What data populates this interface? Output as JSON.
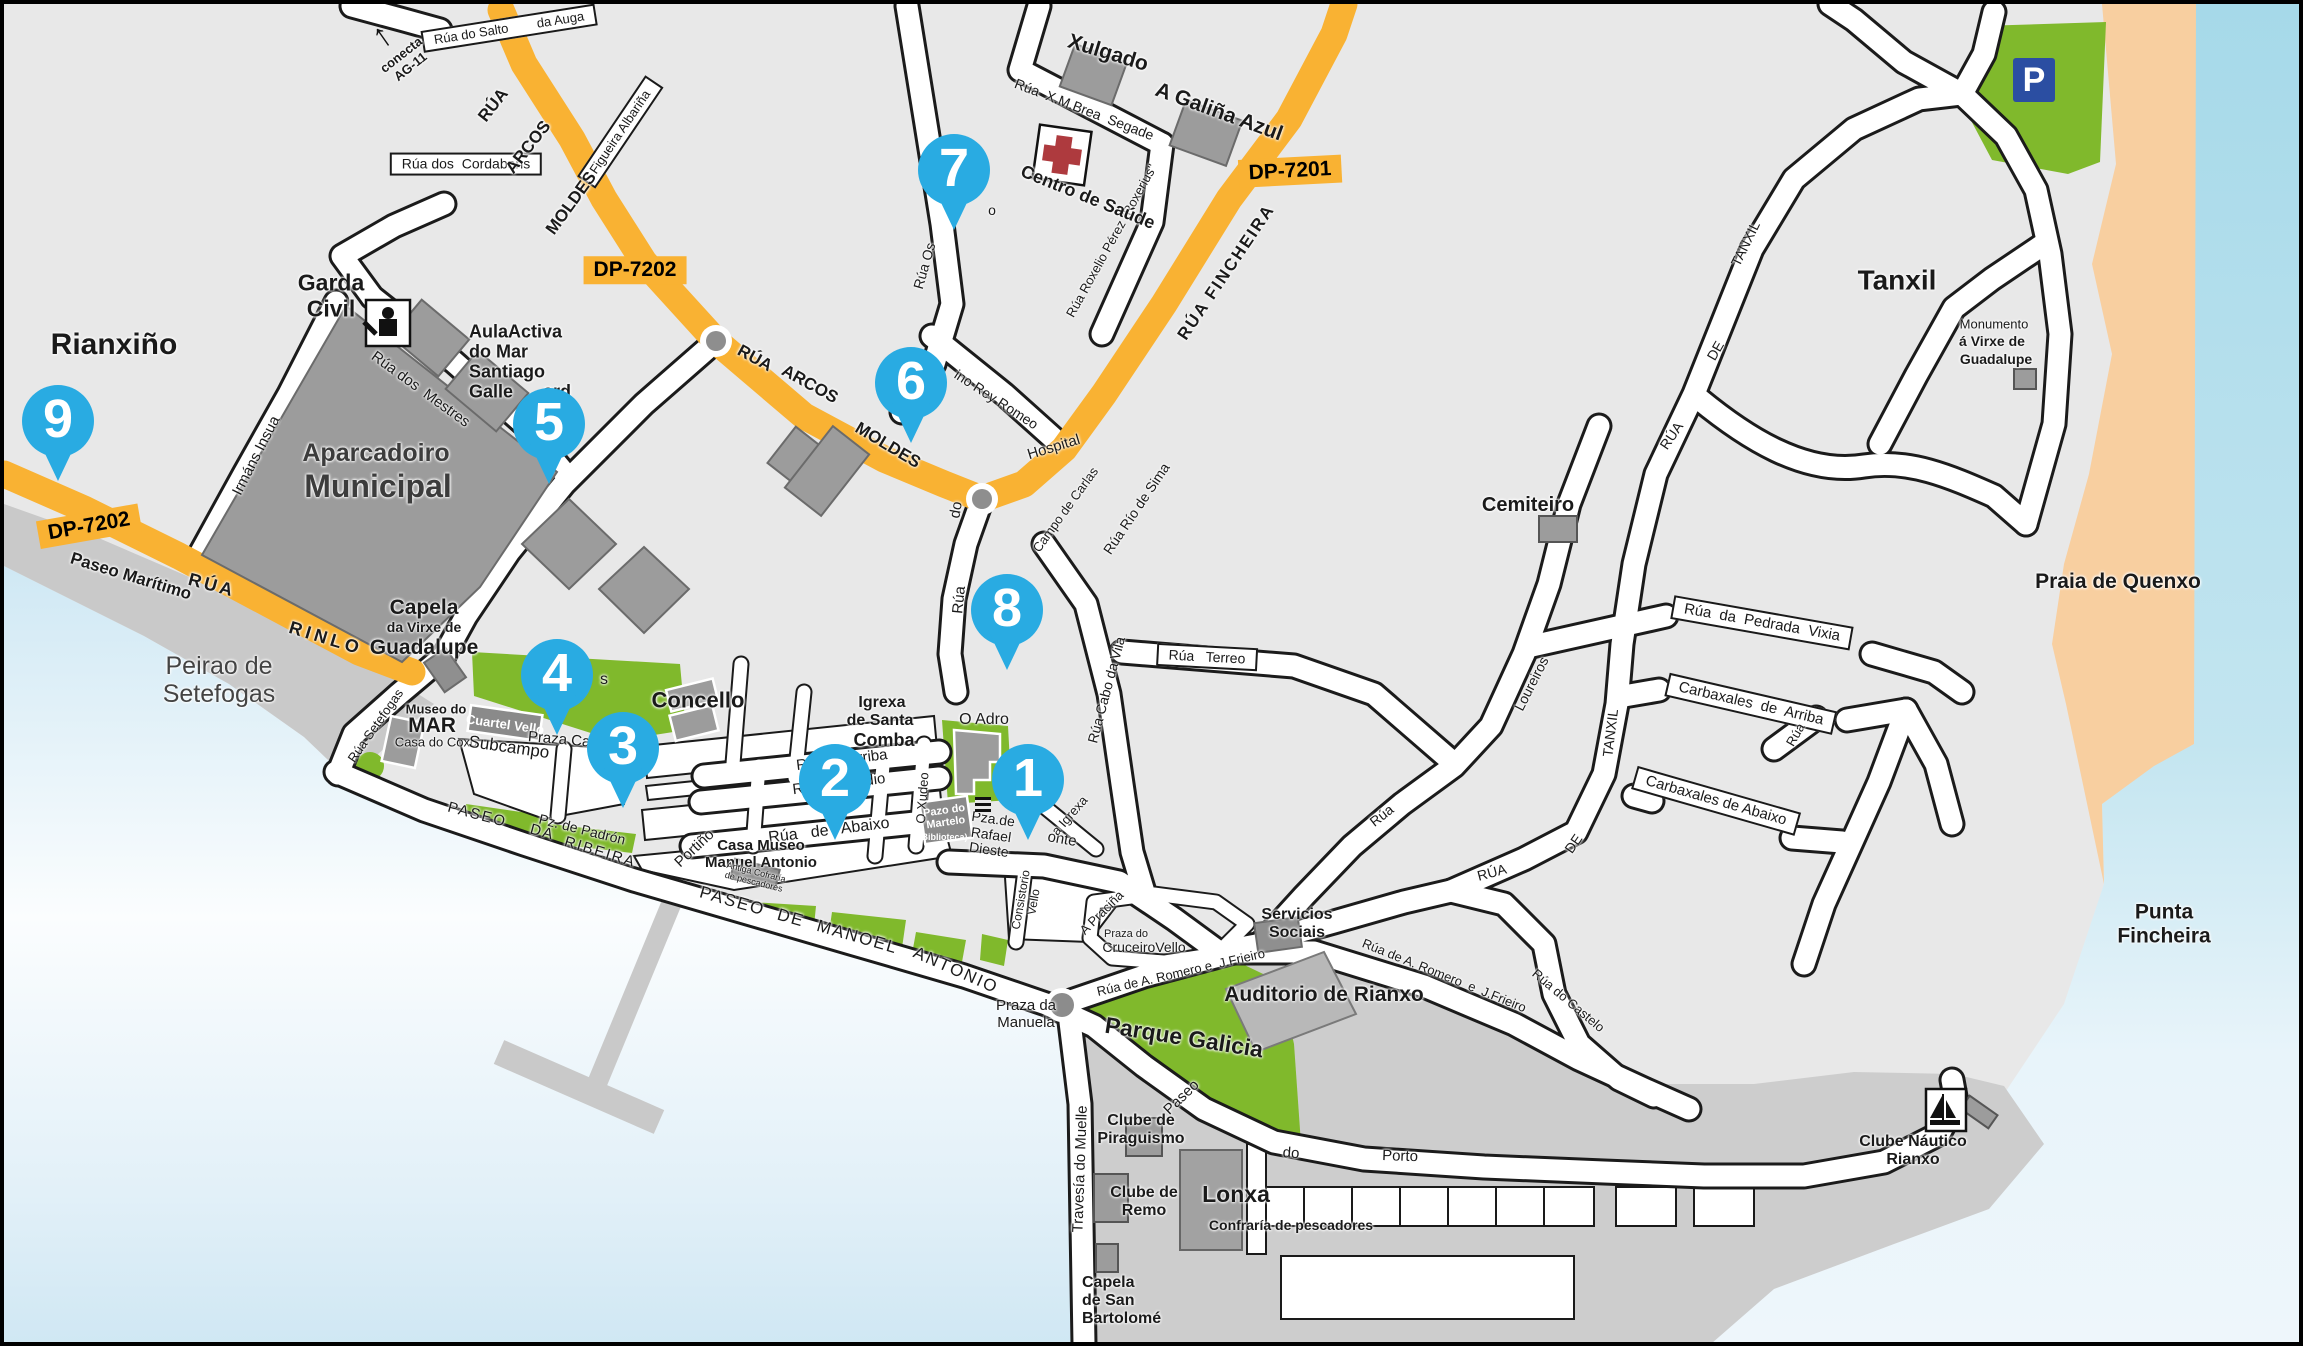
{
  "map_title": "Rianxo town street map",
  "colors": {
    "land": "#e8e8e8",
    "sea_deep": "#a6d9e9",
    "sea_pale": "#eef6fb",
    "sand": "#f8cfa0",
    "park_green": "#80b92c",
    "building_gray": "#9c9c9c",
    "quay_gray": "#c9c9c9",
    "port_gray": "#cdcdcd",
    "road_orange": "#F9B233",
    "marker_blue": "#29ABE2",
    "parking_blue": "#2B4EA2",
    "cross_red": "#AE3A3E"
  },
  "markers": [
    {
      "n": "1",
      "x": 1024,
      "y": 776
    },
    {
      "n": "2",
      "x": 831,
      "y": 776
    },
    {
      "n": "3",
      "x": 619,
      "y": 744
    },
    {
      "n": "4",
      "x": 553,
      "y": 671
    },
    {
      "n": "5",
      "x": 545,
      "y": 420
    },
    {
      "n": "6",
      "x": 907,
      "y": 379
    },
    {
      "n": "7",
      "x": 950,
      "y": 166
    },
    {
      "n": "8",
      "x": 1003,
      "y": 606
    },
    {
      "n": "9",
      "x": 54,
      "y": 417
    }
  ],
  "icons": [
    {
      "type": "parking",
      "glyph": "P",
      "x": 2030,
      "y": 76
    },
    {
      "type": "arrow-up",
      "glyph": "↑",
      "x": 378,
      "y": 32,
      "r": -35
    },
    {
      "type": "stairs",
      "glyph": "",
      "x": 979,
      "y": 801
    }
  ],
  "labels": [
    {
      "n": "rianxino",
      "t": "Rianxiño",
      "x": 110,
      "y": 341,
      "s": 30,
      "w": 700
    },
    {
      "n": "badge-dp7202-west",
      "t": "DP-7202",
      "x": 85,
      "y": 522,
      "s": 21,
      "w": 700,
      "bg": "orange",
      "r": -10
    },
    {
      "n": "paseo-maritimo",
      "t": "Paseo Marítimo",
      "x": 127,
      "y": 572,
      "s": 17,
      "w": 700,
      "r": 17
    },
    {
      "n": "rua-rinlo-1",
      "t": "RÚA",
      "x": 208,
      "y": 581,
      "s": 18,
      "w": 700,
      "r": 15,
      "ls": 3
    },
    {
      "n": "rua-rinlo-2",
      "t": "RINLO",
      "x": 322,
      "y": 634,
      "s": 18,
      "w": 700,
      "r": 17,
      "ls": 4
    },
    {
      "n": "peirao-setefogas",
      "t": "Peirao de\nSetefogas",
      "x": 215,
      "y": 676,
      "s": 25,
      "c": "#444"
    },
    {
      "n": "garda-civil",
      "t": "Garda\nCivil",
      "x": 327,
      "y": 292,
      "s": 23,
      "w": 700
    },
    {
      "n": "irmans-insua",
      "t": "Irmáns Insua",
      "x": 253,
      "y": 452,
      "s": 15,
      "r": -63
    },
    {
      "n": "rua-dos-mestres",
      "t": "Rúa dos  Mestres",
      "x": 416,
      "y": 386,
      "s": 15,
      "r": 36
    },
    {
      "n": "aparcadoiro",
      "t": "Aparcadoiro",
      "x": 372,
      "y": 449,
      "s": 25,
      "w": 700,
      "c": "#3c3c3c"
    },
    {
      "n": "municipal",
      "t": "Municipal",
      "x": 374,
      "y": 483,
      "s": 32,
      "w": 700,
      "c": "#3c3c3c"
    },
    {
      "n": "capela-guadalupe-1",
      "t": "Capela",
      "x": 420,
      "y": 604,
      "s": 21,
      "w": 700
    },
    {
      "n": "capela-guadalupe-2",
      "t": "da Virxe de",
      "x": 420,
      "y": 624,
      "s": 14,
      "w": 700
    },
    {
      "n": "capela-guadalupe-3",
      "t": "Guadalupe",
      "x": 420,
      "y": 644,
      "s": 21,
      "w": 700
    },
    {
      "n": "museo-do-mar-1",
      "t": "Museo do",
      "x": 432,
      "y": 706,
      "s": 13,
      "w": 700
    },
    {
      "n": "museo-do-mar-2",
      "t": "MAR",
      "x": 428,
      "y": 722,
      "s": 21,
      "w": 700
    },
    {
      "n": "casa-do-coxo",
      "t": "Casa do Coxo",
      "x": 432,
      "y": 739,
      "s": 13
    },
    {
      "n": "cuartel-vello",
      "t": "Cuartel Vello",
      "x": 501,
      "y": 721,
      "s": 13,
      "w": 700,
      "c": "#fff",
      "r": 8,
      "hl": 1
    },
    {
      "n": "subcampo",
      "t": "Subcampo",
      "x": 505,
      "y": 743,
      "s": 17,
      "r": 8
    },
    {
      "n": "praza-castelao",
      "t": "Praza Castelao",
      "x": 575,
      "y": 738,
      "s": 15,
      "r": 5
    },
    {
      "n": "green-fragment",
      "t": "s",
      "x": 600,
      "y": 676,
      "s": 16
    },
    {
      "n": "concello",
      "t": "Concello",
      "x": 694,
      "y": 697,
      "s": 22,
      "w": 700
    },
    {
      "n": "rua-setefogas",
      "t": "Rúa Setefogas",
      "x": 372,
      "y": 722,
      "s": 13,
      "r": -55
    },
    {
      "n": "aulaactiva",
      "t": "AulaActiva\ndo Mar\nSantiago\nGalle      ard",
      "x": 465,
      "y": 358,
      "s": 18,
      "w": 700,
      "al": "l"
    },
    {
      "n": "conecta-ag11",
      "t": "conecta\nAG-11",
      "x": 402,
      "y": 57,
      "s": 13,
      "w": 700,
      "r": -38
    },
    {
      "n": "rua-salto-auga",
      "t": "Rúa do Salto        da Auga",
      "x": 505,
      "y": 24,
      "s": 13,
      "bg": "box",
      "r": -9
    },
    {
      "n": "rua-cordabans",
      "t": "Rúa dos  Cordabans",
      "x": 462,
      "y": 160,
      "s": 14,
      "bg": "box"
    },
    {
      "n": "figueira-albarina",
      "t": "Figueira Albariña",
      "x": 616,
      "y": 128,
      "s": 13,
      "bg": "box",
      "r": -56
    },
    {
      "n": "badge-dp7202-top",
      "t": "DP-7202",
      "x": 631,
      "y": 266,
      "s": 21,
      "w": 700,
      "bg": "orange"
    },
    {
      "n": "badge-dp7201",
      "t": "DP-7201",
      "x": 1286,
      "y": 167,
      "s": 21,
      "w": 700,
      "bg": "orange",
      "r": -3
    },
    {
      "n": "arcos-moldes-nw1",
      "t": "RÚA",
      "x": 489,
      "y": 101,
      "s": 17,
      "w": 700,
      "r": -52
    },
    {
      "n": "arcos-moldes-nw2",
      "t": "ARCOS",
      "x": 524,
      "y": 143,
      "s": 17,
      "w": 700,
      "r": -52
    },
    {
      "n": "arcos-moldes-nw3",
      "t": "MOLDES",
      "x": 567,
      "y": 199,
      "s": 17,
      "w": 700,
      "r": -54
    },
    {
      "n": "arcos-moldes-mid1",
      "t": "RÚA",
      "x": 751,
      "y": 354,
      "s": 17,
      "w": 700,
      "r": 29
    },
    {
      "n": "arcos-moldes-mid2",
      "t": "ARCOS",
      "x": 806,
      "y": 380,
      "s": 17,
      "w": 700,
      "r": 29
    },
    {
      "n": "arcos-moldes-mid3",
      "t": "MOLDES",
      "x": 884,
      "y": 441,
      "s": 17,
      "w": 700,
      "r": 31
    },
    {
      "n": "rua-fincheira",
      "t": "RÚA FINCHEIRA",
      "x": 1222,
      "y": 268,
      "s": 17,
      "w": 700,
      "r": -56,
      "ls": 2
    },
    {
      "n": "xulgado",
      "t": "Xulgado",
      "x": 1104,
      "y": 49,
      "s": 21,
      "w": 700,
      "r": 17
    },
    {
      "n": "galina-azul",
      "t": "A Galiña Azul",
      "x": 1215,
      "y": 108,
      "s": 21,
      "w": 700,
      "r": 20
    },
    {
      "n": "rua-brea-segade",
      "t": "Rúa  X.M.Brea  Segade",
      "x": 1080,
      "y": 106,
      "s": 14,
      "r": 21
    },
    {
      "n": "rua-roxelio",
      "t": "Rúa Roxelio Pérez \"Roxerius\"",
      "x": 1108,
      "y": 237,
      "s": 13,
      "r": -61
    },
    {
      "n": "centro-de-saude",
      "t": "Centro de Saúde",
      "x": 1084,
      "y": 193,
      "s": 18,
      "w": 700,
      "r": 22
    },
    {
      "n": "o-fragment",
      "t": "o",
      "x": 988,
      "y": 207,
      "s": 14
    },
    {
      "n": "rua-os",
      "t": "Rúa Os",
      "x": 921,
      "y": 262,
      "s": 14,
      "r": -74
    },
    {
      "n": "rey-romeo",
      "t": "ino Rey Romeo",
      "x": 992,
      "y": 396,
      "s": 14,
      "r": 33
    },
    {
      "n": "hospital",
      "t": "Hospital",
      "x": 1050,
      "y": 444,
      "s": 15,
      "r": -17
    },
    {
      "n": "hospital-do",
      "t": "do",
      "x": 953,
      "y": 506,
      "s": 15,
      "r": -80
    },
    {
      "n": "hospital-rua",
      "t": "Rúa",
      "x": 956,
      "y": 596,
      "s": 15,
      "r": -84
    },
    {
      "n": "campo-de-carlas",
      "t": "Campo de Carlas",
      "x": 1062,
      "y": 506,
      "s": 13,
      "r": -54
    },
    {
      "n": "rua-rio-de-sima",
      "t": "Rúa Río de Sima",
      "x": 1133,
      "y": 505,
      "s": 14,
      "r": -56
    },
    {
      "n": "rua-terreo",
      "t": "Rúa   Terreo",
      "x": 1203,
      "y": 653,
      "s": 14,
      "bg": "box",
      "r": 3
    },
    {
      "n": "rua-cabo-da-vila",
      "t": "Rúa Cabo da Vila",
      "x": 1103,
      "y": 686,
      "s": 14,
      "r": -75
    },
    {
      "n": "igrexa-1",
      "t": "Igrexa",
      "x": 878,
      "y": 699,
      "s": 16,
      "w": 700
    },
    {
      "n": "igrexa-2",
      "t": "de Santa",
      "x": 876,
      "y": 717,
      "s": 16,
      "w": 700
    },
    {
      "n": "igrexa-3",
      "t": "Comba",
      "x": 880,
      "y": 736,
      "s": 18,
      "w": 700
    },
    {
      "n": "o-adro",
      "t": "O Adro",
      "x": 980,
      "y": 716,
      "s": 16
    },
    {
      "n": "onte-fragment",
      "t": "onte",
      "x": 1058,
      "y": 836,
      "s": 15,
      "r": 10
    },
    {
      "n": "a-igrexa",
      "t": "a Igrexa",
      "x": 1066,
      "y": 812,
      "s": 13,
      "r": -49
    },
    {
      "n": "rua-de-arriba",
      "t": "Rúa de Arriba",
      "x": 838,
      "y": 757,
      "s": 15,
      "r": -7
    },
    {
      "n": "rua-do-medio",
      "t": "Rúa do Medio",
      "x": 835,
      "y": 781,
      "s": 15,
      "r": -7
    },
    {
      "n": "rua-de-abaixo",
      "t": "Rúa   de   Abaixo",
      "x": 825,
      "y": 827,
      "s": 16,
      "r": -7
    },
    {
      "n": "o-xudeo",
      "t": "O Xudeo",
      "x": 919,
      "y": 794,
      "s": 13,
      "r": -86
    },
    {
      "n": "pazo-do-martelo",
      "t": "Pazo do\nMartelo",
      "x": 941,
      "y": 813,
      "s": 11,
      "w": 700,
      "c": "#fff",
      "r": -8,
      "hl": 1
    },
    {
      "n": "biblioteca",
      "t": "(Biblioteca)",
      "x": 939,
      "y": 833,
      "s": 9,
      "w": 700,
      "c": "#fff",
      "hl": 1
    },
    {
      "n": "pza-rafael-dieste",
      "t": "Pza.de\nRafael\nDieste",
      "x": 987,
      "y": 831,
      "s": 14,
      "r": 8
    },
    {
      "n": "casa-museo",
      "t": "Casa Museo\nManuel Antonio",
      "x": 757,
      "y": 851,
      "s": 15,
      "w": 700
    },
    {
      "n": "antiga-cofraria",
      "t": "Antiga Cofraría\nde pescadores",
      "x": 751,
      "y": 873,
      "s": 9,
      "r": 14
    },
    {
      "n": "portino",
      "t": "Portiño",
      "x": 691,
      "y": 845,
      "s": 15,
      "r": -43
    },
    {
      "n": "pz-de-padron",
      "t": "Pz. de Padrón",
      "x": 578,
      "y": 826,
      "s": 14,
      "r": 14
    },
    {
      "n": "paseo-da",
      "t": "PASEO    DA",
      "x": 497,
      "y": 818,
      "s": 15,
      "r": 15,
      "ls": 2
    },
    {
      "n": "ribeira",
      "t": "RIBEIRA",
      "x": 596,
      "y": 849,
      "s": 15,
      "r": 17,
      "ls": 2
    },
    {
      "n": "paseo-manoel-1",
      "t": "PASEO  DE  MANOEL",
      "x": 795,
      "y": 916,
      "s": 17,
      "r": 16,
      "ls": 2
    },
    {
      "n": "paseo-manoel-2",
      "t": "ANTONIO",
      "x": 952,
      "y": 966,
      "s": 17,
      "r": 24,
      "ls": 2
    },
    {
      "n": "praza-da-manuela",
      "t": "Praza da\nManuela",
      "x": 1022,
      "y": 1011,
      "s": 15
    },
    {
      "n": "consistorio-vello",
      "t": "Consistorio\nVello",
      "x": 1024,
      "y": 897,
      "s": 12,
      "r": -80
    },
    {
      "n": "a-pracina",
      "t": "A Praciña",
      "x": 1098,
      "y": 909,
      "s": 13,
      "r": -45
    },
    {
      "n": "praza-do",
      "t": "Praza do",
      "x": 1122,
      "y": 930,
      "s": 11
    },
    {
      "n": "cruceiro-vello",
      "t": "CruceiroVello",
      "x": 1140,
      "y": 944,
      "s": 14
    },
    {
      "n": "servicios-sociais",
      "t": "Servicios\nSociais",
      "x": 1293,
      "y": 920,
      "s": 16,
      "w": 700
    },
    {
      "n": "romero-frieiro-1",
      "t": "Rúa de A. Romero e  J.Frieiro",
      "x": 1177,
      "y": 969,
      "s": 13,
      "r": -13
    },
    {
      "n": "auditorio",
      "t": "Auditorio de Rianxo",
      "x": 1320,
      "y": 991,
      "s": 21,
      "w": 700
    },
    {
      "n": "parque-galicia",
      "t": "Parque Galicia",
      "x": 1180,
      "y": 1034,
      "s": 23,
      "w": 700,
      "r": 9
    },
    {
      "n": "romero-frieiro-2",
      "t": "Rúa de A. Romero  e  J.Frieiro",
      "x": 1440,
      "y": 972,
      "s": 13,
      "r": 22
    },
    {
      "n": "rua-fragment-ne",
      "t": "Rúa",
      "x": 1378,
      "y": 812,
      "s": 14,
      "r": -38
    },
    {
      "n": "rua-tanxil-low-1",
      "t": "RÚA",
      "x": 1488,
      "y": 869,
      "s": 14,
      "r": -15
    },
    {
      "n": "rua-tanxil-low-2",
      "t": "DE",
      "x": 1570,
      "y": 840,
      "s": 14,
      "r": -55
    },
    {
      "n": "rua-tanxil-low-3",
      "t": "TANXIL",
      "x": 1607,
      "y": 729,
      "s": 14,
      "r": -83
    },
    {
      "n": "rua-fragment-e",
      "t": "Rúa",
      "x": 1792,
      "y": 731,
      "s": 13,
      "r": -60
    },
    {
      "n": "rua-do-castelo",
      "t": "Rúa do Castelo",
      "x": 1564,
      "y": 997,
      "s": 13,
      "r": 40
    },
    {
      "n": "loureiros",
      "t": "Loureiros",
      "x": 1528,
      "y": 680,
      "s": 14,
      "r": -63
    },
    {
      "n": "cemiteiro",
      "t": "Cemiteiro",
      "x": 1524,
      "y": 501,
      "s": 20,
      "w": 700
    },
    {
      "n": "pedrada-vixia",
      "t": "Rúa  da  Pedrada  Vixia",
      "x": 1758,
      "y": 619,
      "s": 15,
      "bg": "box",
      "r": 10
    },
    {
      "n": "carbaxales-arriba",
      "t": "Carbaxales  de  Arriba",
      "x": 1747,
      "y": 700,
      "s": 15,
      "bg": "box",
      "r": 13
    },
    {
      "n": "carbaxales-abaixo",
      "t": "Carbaxales de Abaixo",
      "x": 1712,
      "y": 797,
      "s": 15,
      "bg": "box",
      "r": 16
    },
    {
      "n": "rua-tanxil-up-1",
      "t": "RÚA",
      "x": 1668,
      "y": 432,
      "s": 14,
      "r": -56
    },
    {
      "n": "rua-tanxil-up-2",
      "t": "DE",
      "x": 1712,
      "y": 347,
      "s": 14,
      "r": -60
    },
    {
      "n": "rua-tanxil-up-3",
      "t": "TANXIL",
      "x": 1742,
      "y": 240,
      "s": 14,
      "r": -64
    },
    {
      "n": "tanxil",
      "t": "Tanxil",
      "x": 1893,
      "y": 276,
      "s": 28,
      "w": 700
    },
    {
      "n": "monumento-1",
      "t": "Monumento",
      "x": 1990,
      "y": 321,
      "s": 13
    },
    {
      "n": "monumento-2",
      "t": "á Virxe de",
      "x": 1988,
      "y": 338,
      "s": 14,
      "w": 700
    },
    {
      "n": "monumento-3",
      "t": "Guadalupe",
      "x": 1992,
      "y": 356,
      "s": 14,
      "w": 700
    },
    {
      "n": "praia-de-quenxo",
      "t": "Praia de Quenxo",
      "x": 2114,
      "y": 578,
      "s": 21,
      "w": 700
    },
    {
      "n": "punta-fincheira",
      "t": "Punta\nFincheira",
      "x": 2160,
      "y": 920,
      "s": 21,
      "w": 700
    },
    {
      "n": "clube-nautico",
      "t": "Clube Náutico\nRianxo",
      "x": 1909,
      "y": 1147,
      "s": 16,
      "w": 700
    },
    {
      "n": "clube-piraguismo",
      "t": "Clube de\nPiraguismo",
      "x": 1137,
      "y": 1126,
      "s": 16,
      "w": 700
    },
    {
      "n": "clube-remo",
      "t": "Clube de\nRemo",
      "x": 1140,
      "y": 1198,
      "s": 16,
      "w": 700
    },
    {
      "n": "lonxa",
      "t": "Lonxa",
      "x": 1232,
      "y": 1191,
      "s": 23,
      "w": 700
    },
    {
      "n": "confraria",
      "t": "Confraría de pescadores",
      "x": 1287,
      "y": 1222,
      "s": 14,
      "w": 700
    },
    {
      "n": "capela-bartolome",
      "t": "Capela\nde San\nBartolomé",
      "x": 1078,
      "y": 1297,
      "s": 16,
      "w": 700,
      "al": "l"
    },
    {
      "n": "travesia-muelle",
      "t": "Travesía do Muelle",
      "x": 1077,
      "y": 1165,
      "s": 15,
      "r": -88
    },
    {
      "n": "paseo-porto-1",
      "t": "Paseo",
      "x": 1178,
      "y": 1094,
      "s": 15,
      "r": -44
    },
    {
      "n": "paseo-porto-2",
      "t": "do",
      "x": 1287,
      "y": 1150,
      "s": 15,
      "r": 4
    },
    {
      "n": "paseo-porto-3",
      "t": "Porto",
      "x": 1396,
      "y": 1153,
      "s": 15,
      "r": 2
    }
  ]
}
